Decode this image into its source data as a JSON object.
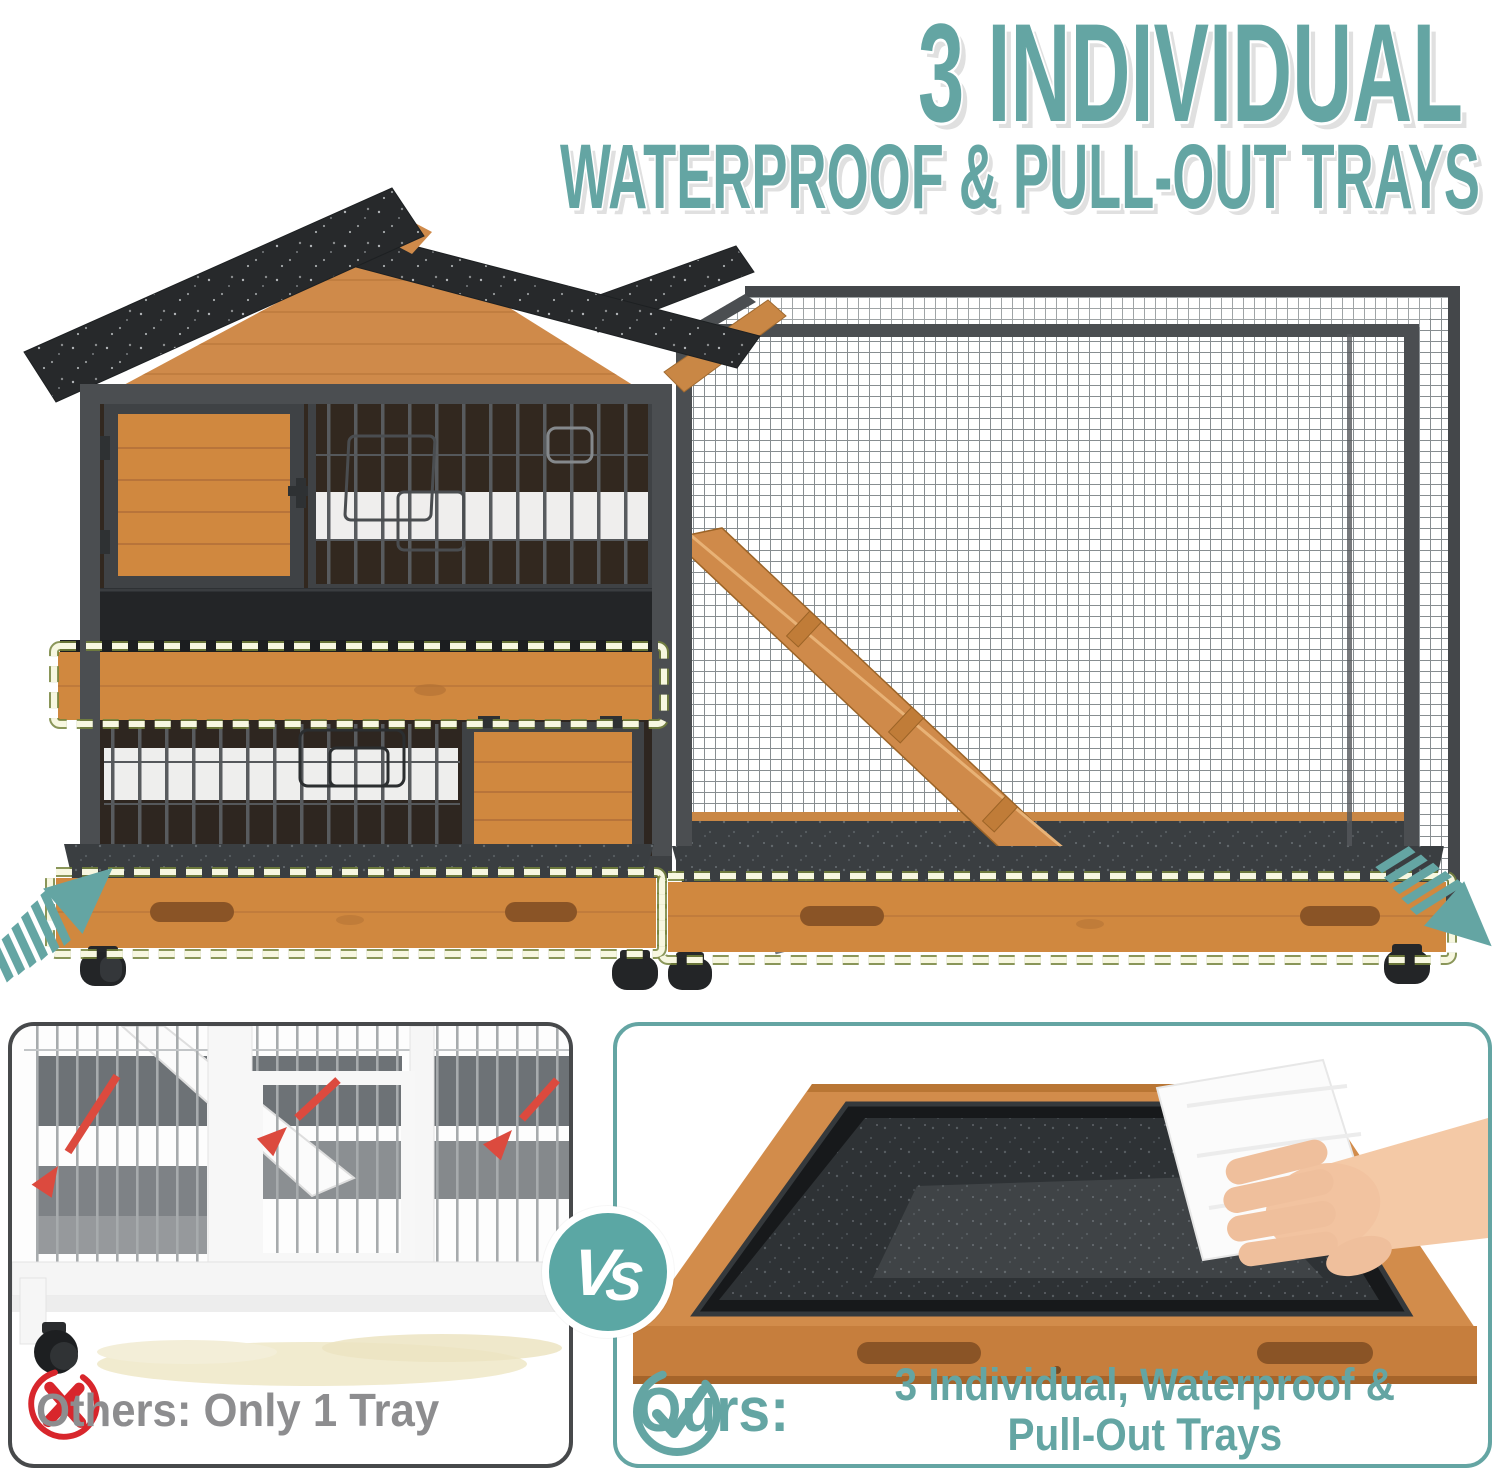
{
  "title": {
    "line1": "3 INDIVIDUAL",
    "line2": "WATERPROOF & PULL-OUT TRAYS"
  },
  "vs_badge": {
    "label": "VS"
  },
  "comparison": {
    "others": {
      "caption": "Others: Only 1 Tray"
    },
    "ours": {
      "caption_label": "Ours:",
      "caption_line1": "3 Individual, Waterproof &",
      "caption_line2": "Pull-Out Trays"
    }
  },
  "colors": {
    "teal_accent": "#64a5a3",
    "red_cross": "#d8262c",
    "red_arrow": "#dc4a3e",
    "gray_caption_text": "#8d8d8f",
    "wood": "#d0883f",
    "roof_asphalt": "#27292b",
    "metal_frame": "#4b4e51",
    "tray_surface": "#3c4043",
    "dash_outline_pale": "#f7f7e0",
    "dash_outline_green": "#75843c",
    "spill": "#f1ebcf"
  }
}
